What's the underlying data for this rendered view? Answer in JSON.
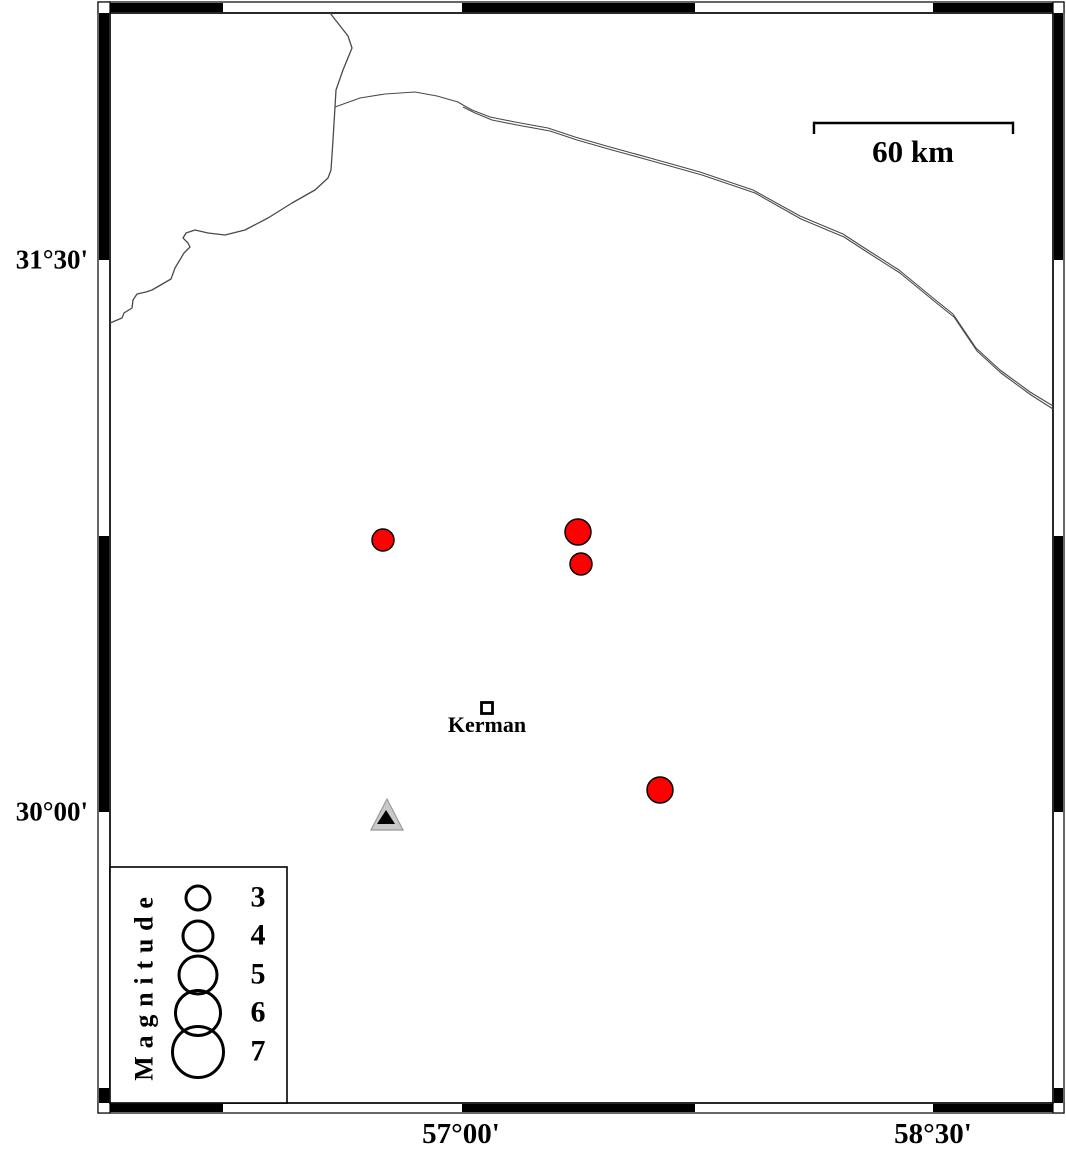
{
  "figure": {
    "type": "seismicity-map",
    "region_note": "map frame with alternating black/white fancy border"
  },
  "frame": {
    "outer": {
      "x": 98,
      "y": 2,
      "w": 966,
      "h": 1111
    },
    "inner": {
      "x": 110,
      "y": 13,
      "w": 943,
      "h": 1090
    },
    "top_black_segments": [
      [
        110,
        223
      ],
      [
        462,
        695
      ],
      [
        933,
        1053
      ]
    ],
    "left_black_segments": [
      [
        13,
        260
      ],
      [
        536,
        812
      ],
      [
        1088,
        1103
      ]
    ]
  },
  "axis": {
    "left": [
      {
        "text": "31°30'",
        "y": 260
      },
      {
        "text": "30°00'",
        "y": 812
      }
    ],
    "bottom": [
      {
        "text": "57°00'",
        "x": 461
      },
      {
        "text": "58°30'",
        "x": 933
      }
    ]
  },
  "scalebar": {
    "label": "60 km",
    "x1": 814,
    "x2": 1013,
    "y": 123,
    "tick": 11,
    "label_x": 913,
    "label_y": 136
  },
  "lines": {
    "border": [
      [
        330,
        13
      ],
      [
        348,
        36
      ],
      [
        352,
        48
      ],
      [
        343,
        70
      ],
      [
        336,
        90
      ],
      [
        335,
        107
      ],
      [
        333,
        140
      ],
      [
        331,
        170
      ],
      [
        328,
        178
      ],
      [
        315,
        190
      ],
      [
        292,
        203
      ],
      [
        268,
        218
      ],
      [
        245,
        230
      ],
      [
        225,
        235
      ],
      [
        208,
        233
      ],
      [
        195,
        230
      ],
      [
        186,
        233
      ],
      [
        183,
        238
      ],
      [
        188,
        243
      ],
      [
        190,
        247
      ],
      [
        184,
        253
      ],
      [
        175,
        268
      ],
      [
        171,
        279
      ],
      [
        152,
        290
      ],
      [
        146,
        292
      ],
      [
        137,
        294
      ],
      [
        133,
        300
      ],
      [
        132,
        308
      ],
      [
        124,
        313
      ],
      [
        122,
        318
      ],
      [
        110,
        323
      ]
    ],
    "road": [
      [
        335,
        107
      ],
      [
        360,
        98
      ],
      [
        385,
        94
      ],
      [
        415,
        92
      ],
      [
        437,
        96
      ],
      [
        458,
        102
      ],
      [
        463,
        105
      ],
      [
        472,
        110
      ],
      [
        490,
        117
      ],
      [
        515,
        122
      ],
      [
        548,
        128
      ],
      [
        575,
        137
      ],
      [
        610,
        147
      ],
      [
        650,
        158
      ],
      [
        700,
        172
      ],
      [
        753,
        190
      ],
      [
        800,
        216
      ],
      [
        843,
        234
      ],
      [
        866,
        249
      ],
      [
        899,
        270
      ],
      [
        933,
        298
      ],
      [
        953,
        314
      ],
      [
        976,
        348
      ],
      [
        1000,
        370
      ],
      [
        1030,
        392
      ],
      [
        1053,
        406
      ]
    ],
    "road2": [
      [
        463,
        107
      ],
      [
        475,
        113
      ],
      [
        492,
        120
      ],
      [
        517,
        125
      ],
      [
        550,
        131
      ],
      [
        577,
        140
      ],
      [
        612,
        150
      ],
      [
        652,
        161
      ],
      [
        702,
        175
      ],
      [
        755,
        193
      ],
      [
        801,
        219
      ],
      [
        844,
        237
      ],
      [
        867,
        252
      ],
      [
        900,
        273
      ],
      [
        934,
        301
      ],
      [
        954,
        317
      ],
      [
        977,
        351
      ],
      [
        1001,
        373
      ],
      [
        1031,
        395
      ],
      [
        1053,
        409
      ]
    ]
  },
  "city": {
    "label": "Kerman",
    "x": 487,
    "y": 708,
    "square": 11,
    "label_y": 713
  },
  "station": {
    "cx": 387,
    "apex_y": 799,
    "base_y": 830,
    "half_w": 16,
    "inner": {
      "apex_y": 810,
      "base_y": 824,
      "half_w": 9
    }
  },
  "earthquakes": [
    {
      "x": 383,
      "y": 540,
      "r": 11
    },
    {
      "x": 578,
      "y": 532,
      "r": 13
    },
    {
      "x": 581,
      "y": 564,
      "r": 11
    },
    {
      "x": 660,
      "y": 790,
      "r": 13
    }
  ],
  "legend": {
    "box": {
      "x": 110,
      "y": 867,
      "w": 177,
      "h": 236
    },
    "title": "Magnitude",
    "title_x": 144,
    "title_y": 985,
    "cx": 198,
    "label_x": 258,
    "entries": [
      {
        "label": "3",
        "y": 898,
        "r": 12
      },
      {
        "label": "4",
        "y": 936,
        "r": 15
      },
      {
        "label": "5",
        "y": 975,
        "r": 19
      },
      {
        "label": "6",
        "y": 1013,
        "r": 22.5
      },
      {
        "label": "7",
        "y": 1052,
        "r": 25.5
      }
    ]
  },
  "colors": {
    "quake_fill": "#ff0000",
    "marker_stroke": "#000000",
    "station_fill": "#c9c9c9",
    "station_stroke": "#999999",
    "station_inner": "#000000",
    "geo_line": "#4a4a4a",
    "frame": "#000000"
  }
}
